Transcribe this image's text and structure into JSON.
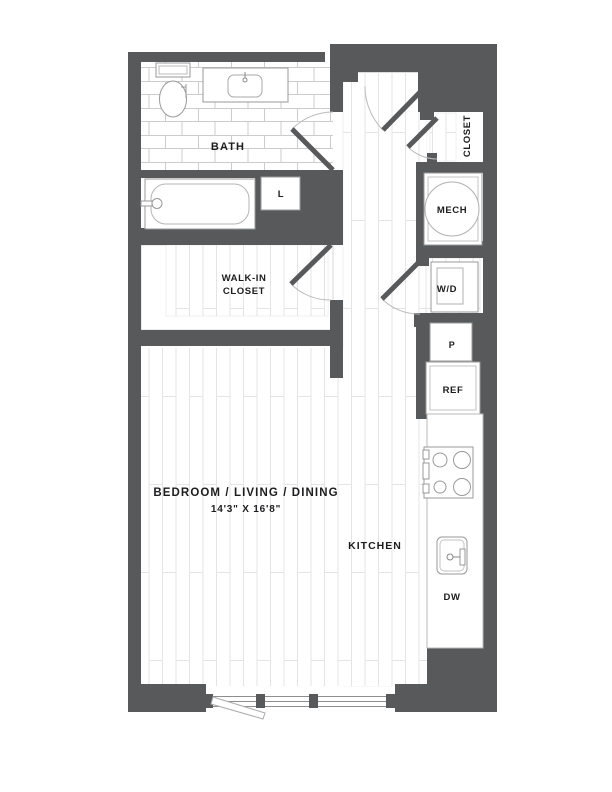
{
  "colors": {
    "wall": "#58595b",
    "fixture_line": "#999999",
    "inner_line": "#c3c3c3",
    "floor_line": "#e4e4e4",
    "tile_line": "#cccccc",
    "door_arc": "#bbbbbb",
    "text": "#1d1d1f"
  },
  "labels": {
    "bath": "BATH",
    "linen": "L",
    "walk_in_line1": "WALK-IN",
    "walk_in_line2": "CLOSET",
    "closet": "CLOSET",
    "mech": "MECH",
    "washer_dryer": "W/D",
    "pantry": "P",
    "refrigerator": "REF",
    "kitchen": "KITCHEN",
    "dishwasher": "DW",
    "main_room": "BEDROOM / LIVING / DINING",
    "main_room_dims": "14'3\" X 16'8\""
  }
}
